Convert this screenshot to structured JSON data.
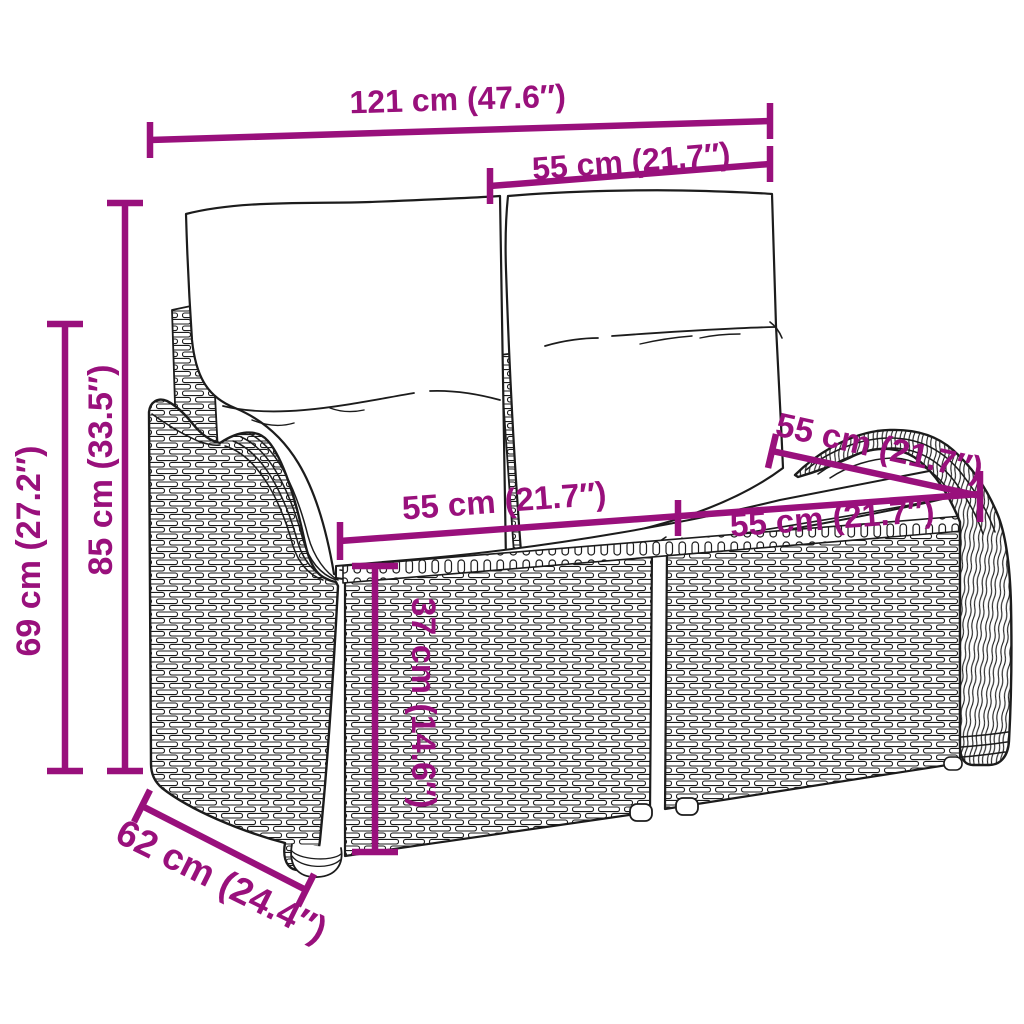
{
  "page": {
    "type": "product-dimension-diagram",
    "background": "#ffffff"
  },
  "colors": {
    "dimension": "#99107C",
    "line_art": "#1c1c1c"
  },
  "dims": {
    "width_total": "121 cm (47.6″)",
    "width_backrest": "55 cm (21.7″)",
    "height_total": "85 cm (33.5″)",
    "height_armrest": "69 cm (27.2″)",
    "seat_width_left": "55 cm (21.7″)",
    "seat_width_right": "55 cm (21.7″)",
    "seat_depth": "55 cm (21.7″)",
    "seat_height": "37 cm (14.6″)",
    "depth_total": "62 cm (24.4″)"
  }
}
